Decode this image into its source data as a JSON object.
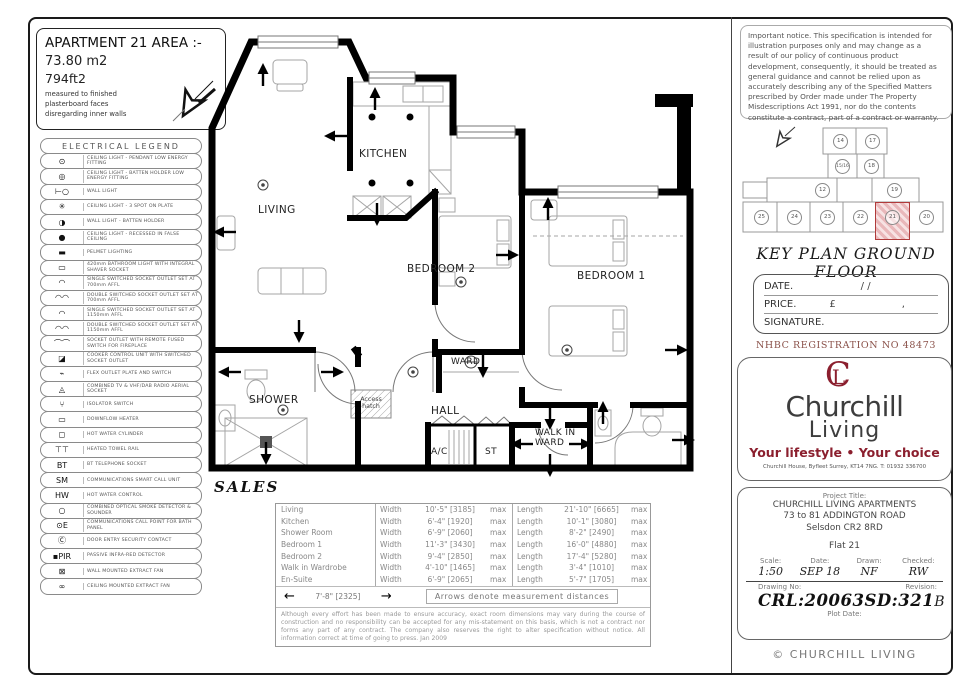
{
  "info_box": {
    "title": "APARTMENT 21 AREA :-",
    "area_m2": "73.80 m2",
    "area_ft2": "794ft2",
    "note_line1": "measured to finished",
    "note_line2": "plasterboard faces",
    "note_line3": "disregarding inner walls"
  },
  "legend": {
    "title": "ELECTRICAL LEGEND",
    "rows": [
      {
        "sym": "⊙",
        "label": "CEILING LIGHT - PENDANT LOW ENERGY FITTING"
      },
      {
        "sym": "◎",
        "label": "CEILING LIGHT - BATTEN HOLDER LOW ENERGY FITTING"
      },
      {
        "sym": "⊢○",
        "label": "WALL LIGHT"
      },
      {
        "sym": "✳",
        "label": "CEILING LIGHT - 3 SPOT ON PLATE"
      },
      {
        "sym": "◑",
        "label": "WALL LIGHT - BATTEN HOLDER"
      },
      {
        "sym": "●",
        "label": "CEILING LIGHT - RECESSED IN FALSE CEILING"
      },
      {
        "sym": "▬",
        "label": "PELMET LIGHTING"
      },
      {
        "sym": "▭",
        "label": "420mm BATHROOM LIGHT WITH INTEGRAL SHAVER SOCKET"
      },
      {
        "sym": "◠",
        "label": "SINGLE SWITCHED SOCKET OUTLET SET AT 700mm AFFL"
      },
      {
        "sym": "◠◠",
        "label": "DOUBLE SWITCHED SOCKET OUTLET SET AT 700mm AFFL"
      },
      {
        "sym": "◠",
        "label": "SINGLE SWITCHED SOCKET OUTLET SET AT 1150mm AFFL"
      },
      {
        "sym": "◠◠",
        "label": "DOUBLE SWITCHED SOCKET OUTLET SET AT 1150mm AFFL"
      },
      {
        "sym": "⌒⌒",
        "label": "SOCKET OUTLET WITH REMOTE FUSED SWITCH FOR FIREPLACE"
      },
      {
        "sym": "◪",
        "label": "COOKER CONTROL UNIT WITH SWITCHED SOCKET OUTLET"
      },
      {
        "sym": "⌁",
        "label": "FLEX OUTLET PLATE AND SWITCH"
      },
      {
        "sym": "◬",
        "label": "COMBINED TV & VHF/DAB RADIO AERIAL SOCKET"
      },
      {
        "sym": "⑂",
        "label": "ISOLATOR SWITCH"
      },
      {
        "sym": "▭",
        "label": "DOWNFLOW HEATER"
      },
      {
        "sym": "◻",
        "label": "HOT WATER CYLINDER"
      },
      {
        "sym": "⊤⊤",
        "label": "HEATED TOWEL RAIL"
      },
      {
        "sym": "BT",
        "label": "BT TELEPHONE SOCKET"
      },
      {
        "sym": "SM",
        "label": "COMMUNICATIONS SMART CALL UNIT"
      },
      {
        "sym": "HW",
        "label": "HOT WATER CONTROL"
      },
      {
        "sym": "○",
        "label": "COMBINED OPTICAL SMOKE DETECTOR & SOUNDER"
      },
      {
        "sym": "⊙E",
        "label": "COMMUNICATIONS CALL POINT FOR BATH PANEL"
      },
      {
        "sym": "Ⓒ",
        "label": "DOOR ENTRY SECURITY CONTACT"
      },
      {
        "sym": "▪PIR",
        "label": "PASSIVE INFRA-RED DETECTOR"
      },
      {
        "sym": "⊠",
        "label": "WALL MOUNTED EXTRACT FAN"
      },
      {
        "sym": "∞",
        "label": "CEILING MOUNTED EXTRACT FAN"
      }
    ]
  },
  "plan": {
    "labels": {
      "living": "LIVING",
      "kitchen": "KITCHEN",
      "bedroom2": "BEDROOM 2",
      "bedroom1": "BEDROOM 1",
      "shower": "SHOWER",
      "ward": "WARD",
      "hall": "HALL",
      "ac": "A/C",
      "st": "ST",
      "walkin": "WALK IN WARD",
      "access_hatch": "Access hatch"
    },
    "sales": "SALES"
  },
  "dims": {
    "width_label": "Width",
    "length_label": "Length",
    "max_label": "max",
    "rows": [
      {
        "room": "Living",
        "width": "10'-5\" [3185]",
        "length": "21'-10\" [6665]"
      },
      {
        "room": "Kitchen",
        "width": "6'-4\" [1920]",
        "length": "10'-1\" [3080]"
      },
      {
        "room": "Shower Room",
        "width": "6'-9\" [2060]",
        "length": "8'-2\" [2490]"
      },
      {
        "room": "Bedroom 1",
        "width": "11'-3\" [3430]",
        "length": "16'-0\" [4880]"
      },
      {
        "room": "Bedroom 2",
        "width": "9'-4\" [2850]",
        "length": "17'-4\" [5280]"
      },
      {
        "room": "Walk in Wardrobe",
        "width": "4'-10\" [1465]",
        "length": "3'-4\" [1010]"
      },
      {
        "room": "En-Suite",
        "width": "6'-9\" [2065]",
        "length": "5'-7\" [1705]"
      }
    ],
    "arrow_dim": "7'-8\" [2325]",
    "arrow_note": "Arrows denote measurement distances",
    "disclaimer": "Although every effort has been made to ensure accuracy, exact room dimensions may vary during the course of construction and no responsibility can be accepted for any mis-statement on this basis, which is not a contract nor forms any part of any contract. The company also reserves the right to alter specification without notice. All information correct at time of going to press. Jan 2009"
  },
  "notice": "Important notice. This specification is intended for illustration purposes only and may change as a result of our policy of continuous product development, consequently, it should be treated as general guidance and cannot be relied upon as accurately describing any of the Specified Matters prescribed by Order made under The Property Misdescriptions Act 1991, nor do the contents constitute a contract, part of a contract or warranty.",
  "key_plan": {
    "title": "KEY PLAN GROUND FLOOR",
    "units": [
      "14",
      "17",
      "15/16",
      "18",
      "12",
      "19",
      "25",
      "24",
      "23",
      "22",
      "21",
      "20"
    ],
    "highlighted_unit": "21",
    "highlight_color": "#b03a3a"
  },
  "price_box": {
    "date_label": "DATE.",
    "date_slashes": "/          /",
    "price_label": "PRICE.",
    "currency": "£",
    "comma": ",",
    "signature_label": "SIGNATURE."
  },
  "nhbc": "NHBC REGISTRATION NO 48473",
  "brand": {
    "monogram_c": "C",
    "monogram_l": "L",
    "name_line1": "Churchill",
    "name_line2": "Living",
    "tagline": "Your lifestyle • Your choice",
    "address": "Churchill House, Byfleet Surrey, KT14 7NG.  T: 01932 336700",
    "accent_color": "#8b1f2e"
  },
  "title_block": {
    "project_title_label": "Project Title:",
    "line1": "CHURCHILL LIVING APARTMENTS",
    "line2": "73 to 81 ADDINGTON ROAD",
    "line3": "Selsdon CR2 8RD",
    "flat": "Flat 21",
    "scale_label": "Scale:",
    "scale": "1:50",
    "date_label": "Date:",
    "date": "SEP 18",
    "drawn_label": "Drawn:",
    "drawn": "NF",
    "checked_label": "Checked:",
    "checked": "RW",
    "drawing_no_label": "Drawing No:",
    "drawing_no": "CRL:20063SD:321",
    "revision_label": "Revision:",
    "revision": "B",
    "plot_date_label": "Plot Date:"
  },
  "copyright": "© CHURCHILL LIVING"
}
